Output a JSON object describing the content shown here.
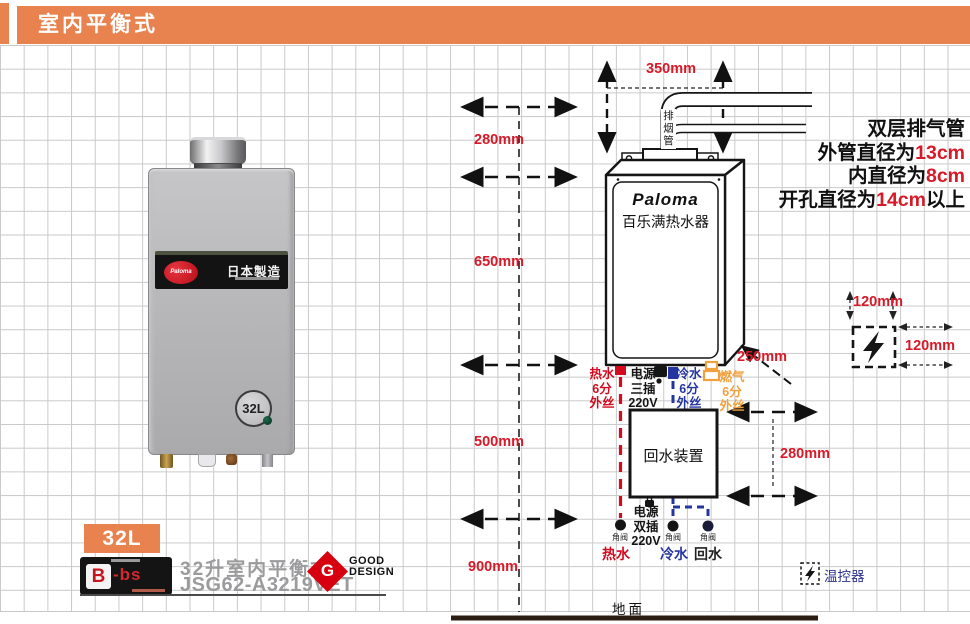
{
  "header": {
    "title": "室内平衡式"
  },
  "exhaust_note": {
    "line1": "双层排气管",
    "line2_prefix": "外管直径为",
    "line2_value": "13cm",
    "line3_prefix": "内直径为",
    "line3_value": "8cm",
    "line4_prefix": "开孔直径为",
    "line4_value": "14cm",
    "line4_suffix": "以上"
  },
  "dimensions": {
    "flue_width": "350mm",
    "wall_top": "280mm",
    "wall_mid": "650mm",
    "wall_low": "500mm",
    "floor": "900mm",
    "side_clearance": "250mm",
    "return_height": "280mm",
    "thermo_top": "120mm",
    "thermo_side": "120mm"
  },
  "diagram": {
    "flue_pipe_label": "排烟管",
    "unit_brand": "Paloma",
    "unit_name": "百乐满热水器",
    "conn_hot": {
      "l1": "热水",
      "l2": "6分",
      "l3": "外丝"
    },
    "conn_power": {
      "l1": "电源",
      "l2": "三插",
      "l3": "220V"
    },
    "conn_cold": {
      "l1": "冷水",
      "l2": "6分",
      "l3": "外丝"
    },
    "conn_gas": {
      "l1": "燃气",
      "l2": "6分",
      "l3": "外丝"
    },
    "return_device": "回水装置",
    "power_lower": {
      "l1": "电源",
      "l2": "双插",
      "l3": "220V"
    },
    "valve": "角阀",
    "pipe_hot": "热水",
    "pipe_cold": "冷水",
    "pipe_return": "回水",
    "thermostat": "温控器",
    "ground": "地面"
  },
  "product": {
    "band_brand": "Paloma",
    "band_made": "日本製造",
    "dial": "32L"
  },
  "footer": {
    "capacity": "32L",
    "cert_main": "B",
    "cert_suffix": "-bs",
    "name": "32升室内平衡式",
    "model": "JSG62-A3219VET",
    "award_letter": "G",
    "award_top": "GOOD",
    "award_bottom": "DESIGN"
  },
  "colors": {
    "header_orange": "#E8824F",
    "dimension_red": "#D71A28",
    "hot_red": "#D40A1E",
    "cold_blue": "#2535A0",
    "gas_orange": "#F2A03D",
    "model_gray": "#9B9B9D",
    "good_design_red": "#D7000F"
  }
}
